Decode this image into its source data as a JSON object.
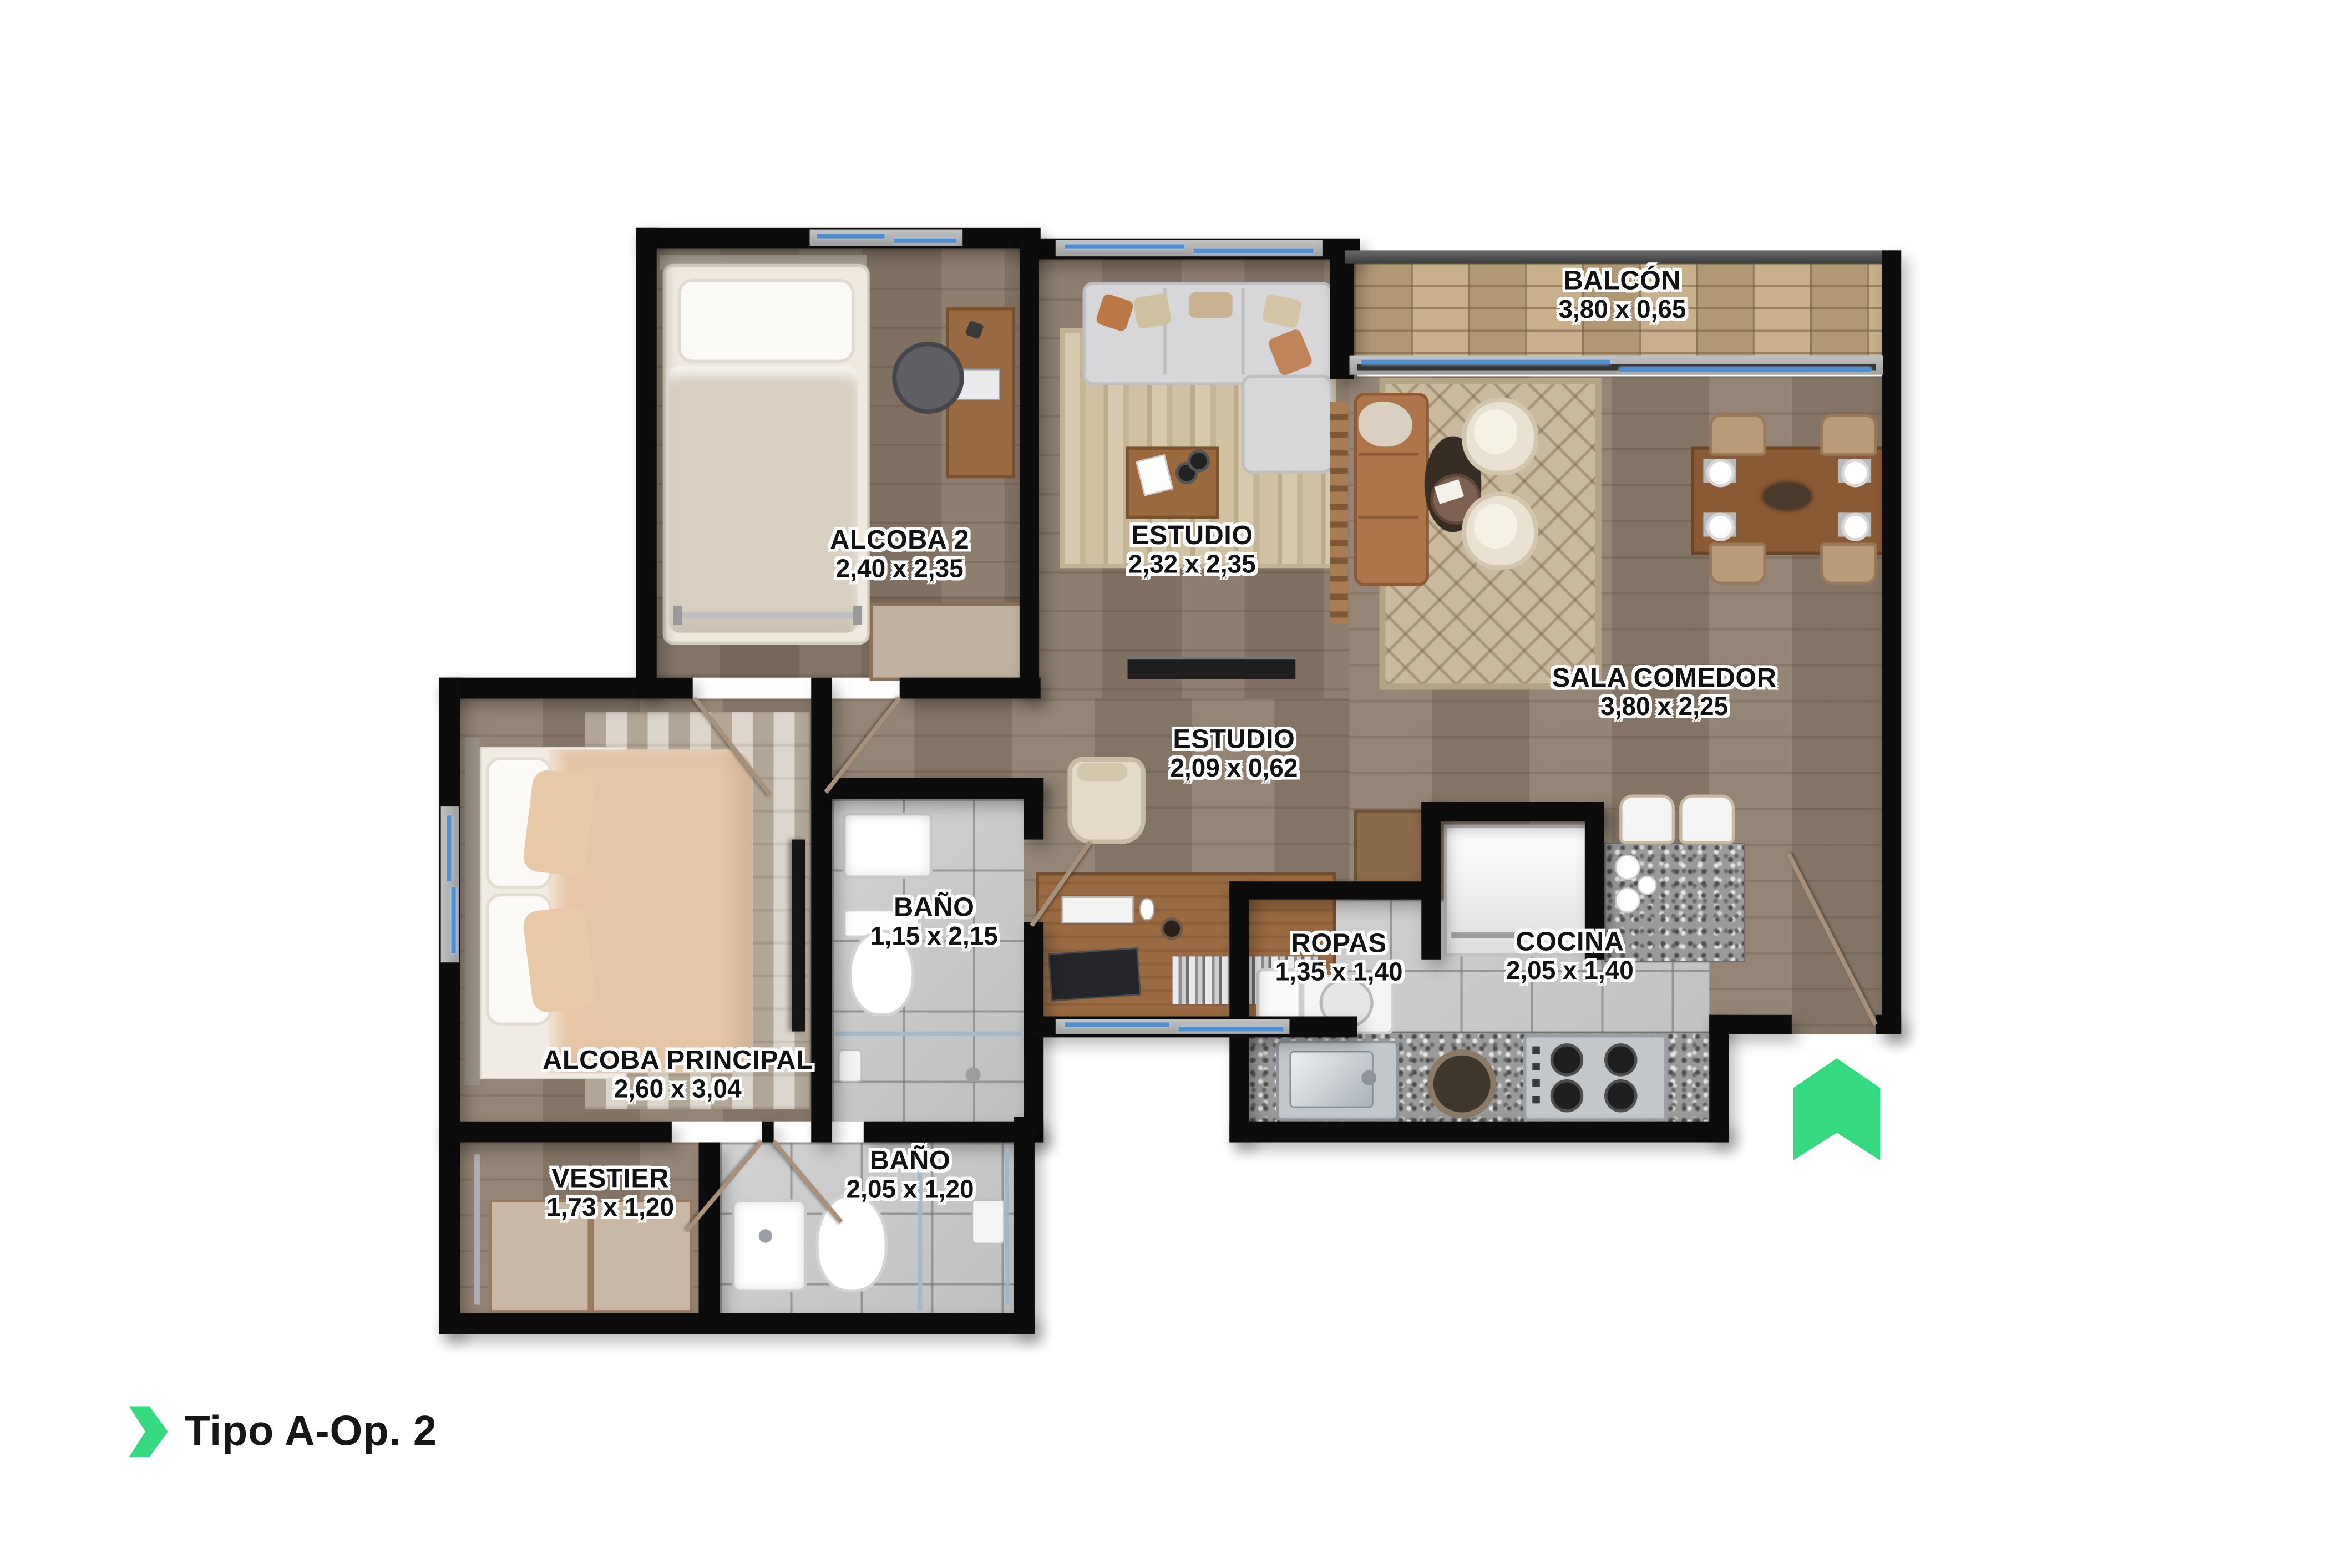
{
  "title": {
    "label": "Tipo A-Op. 2"
  },
  "colors": {
    "accent_green": "#35d97f",
    "wall_black": "#0c0c0c"
  },
  "rooms": [
    {
      "name": "BALCÓN",
      "dims": "3,80 x 0,65"
    },
    {
      "name": "ALCOBA 2",
      "dims": "2,40 x 2,35"
    },
    {
      "name": "ESTUDIO",
      "dims": "2,32 x 2,35"
    },
    {
      "name": "SALA COMEDOR",
      "dims": "3,80 x 2,25"
    },
    {
      "name": "ESTUDIO",
      "dims": "2,09 x 0,62"
    },
    {
      "name": "BAÑO",
      "dims": "1,15 x 2,15"
    },
    {
      "name": "ROPAS",
      "dims": "1,35 x 1,40"
    },
    {
      "name": "COCINA",
      "dims": "2,05 x 1,40"
    },
    {
      "name": "ALCOBA PRINCIPAL",
      "dims": "2,60 x 3,04"
    },
    {
      "name": "VESTIER",
      "dims": "1,73 x 1,20"
    },
    {
      "name": "BAÑO",
      "dims": "2,05 x 1,20"
    }
  ]
}
